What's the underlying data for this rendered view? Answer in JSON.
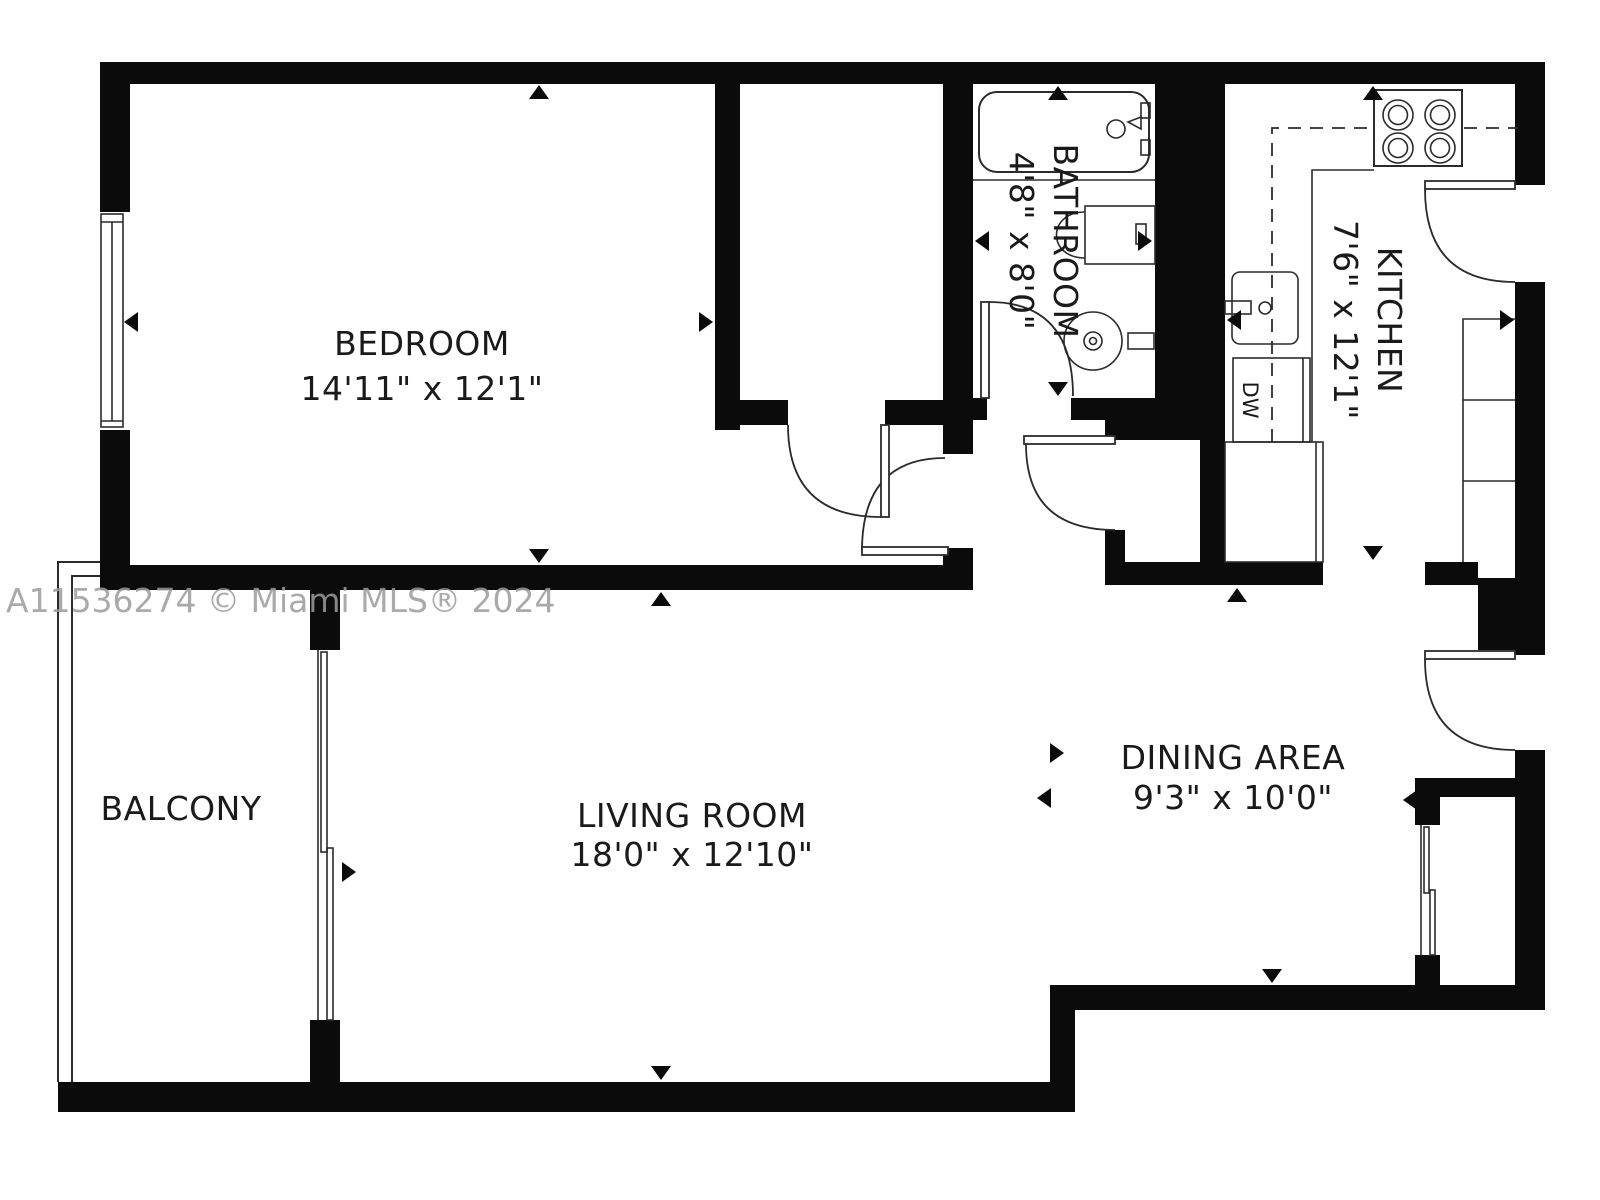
{
  "plan": {
    "watermark": "A11536274 © Miami MLS® 2024",
    "rooms": {
      "bedroom": {
        "name": "BEDROOM",
        "dims": "14'11\" x 12'1\""
      },
      "living_room": {
        "name": "LIVING ROOM",
        "dims": "18'0\" x 12'10\""
      },
      "dining_area": {
        "name": "DINING AREA",
        "dims": "9'3\" x 10'0\""
      },
      "kitchen": {
        "name": "KITCHEN",
        "dims": "7'6\" x 12'1\""
      },
      "bathroom": {
        "name": "BATHROOM",
        "dims": "4'8\" x 8'0\""
      },
      "balcony": {
        "name": "BALCONY"
      }
    },
    "labels": {
      "dishwasher": "DW"
    },
    "colors": {
      "wall": "#0b0b0b",
      "line": "#2b2b2b",
      "text": "#1a1a1a",
      "watermark": "#9c9c9c",
      "background": "#ffffff"
    }
  }
}
